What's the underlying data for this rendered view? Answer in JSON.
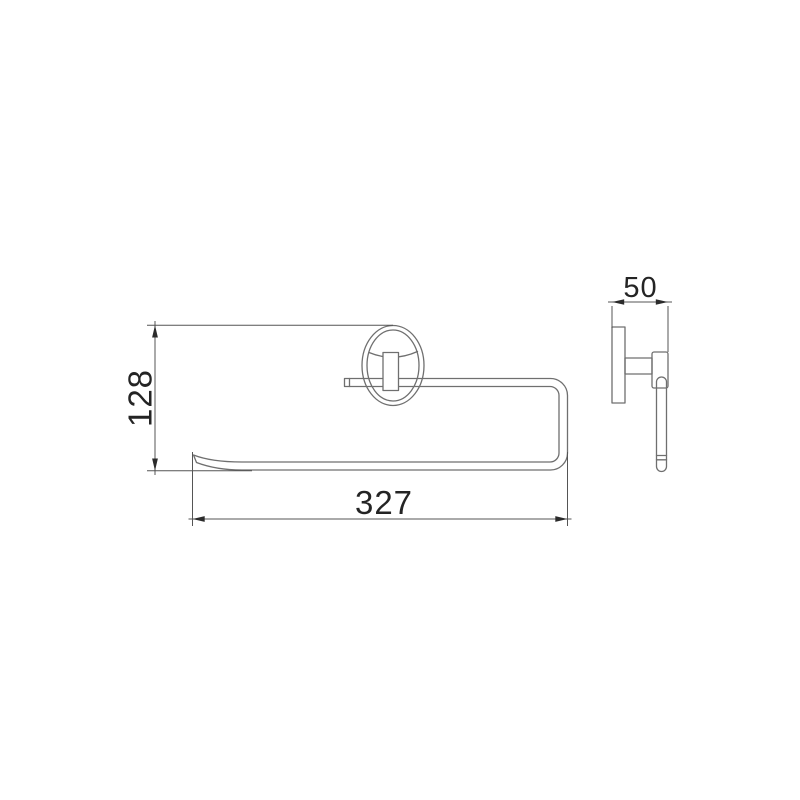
{
  "drawing": {
    "dimensions": {
      "height": {
        "value": "128",
        "orientation": "vertical"
      },
      "width": {
        "value": "327",
        "orientation": "horizontal"
      },
      "depth": {
        "value": "50",
        "orientation": "horizontal"
      }
    },
    "colors": {
      "background": "#ffffff",
      "part_line": "#6f6f6f",
      "dimension_line": "#555555",
      "text": "#242424"
    }
  }
}
